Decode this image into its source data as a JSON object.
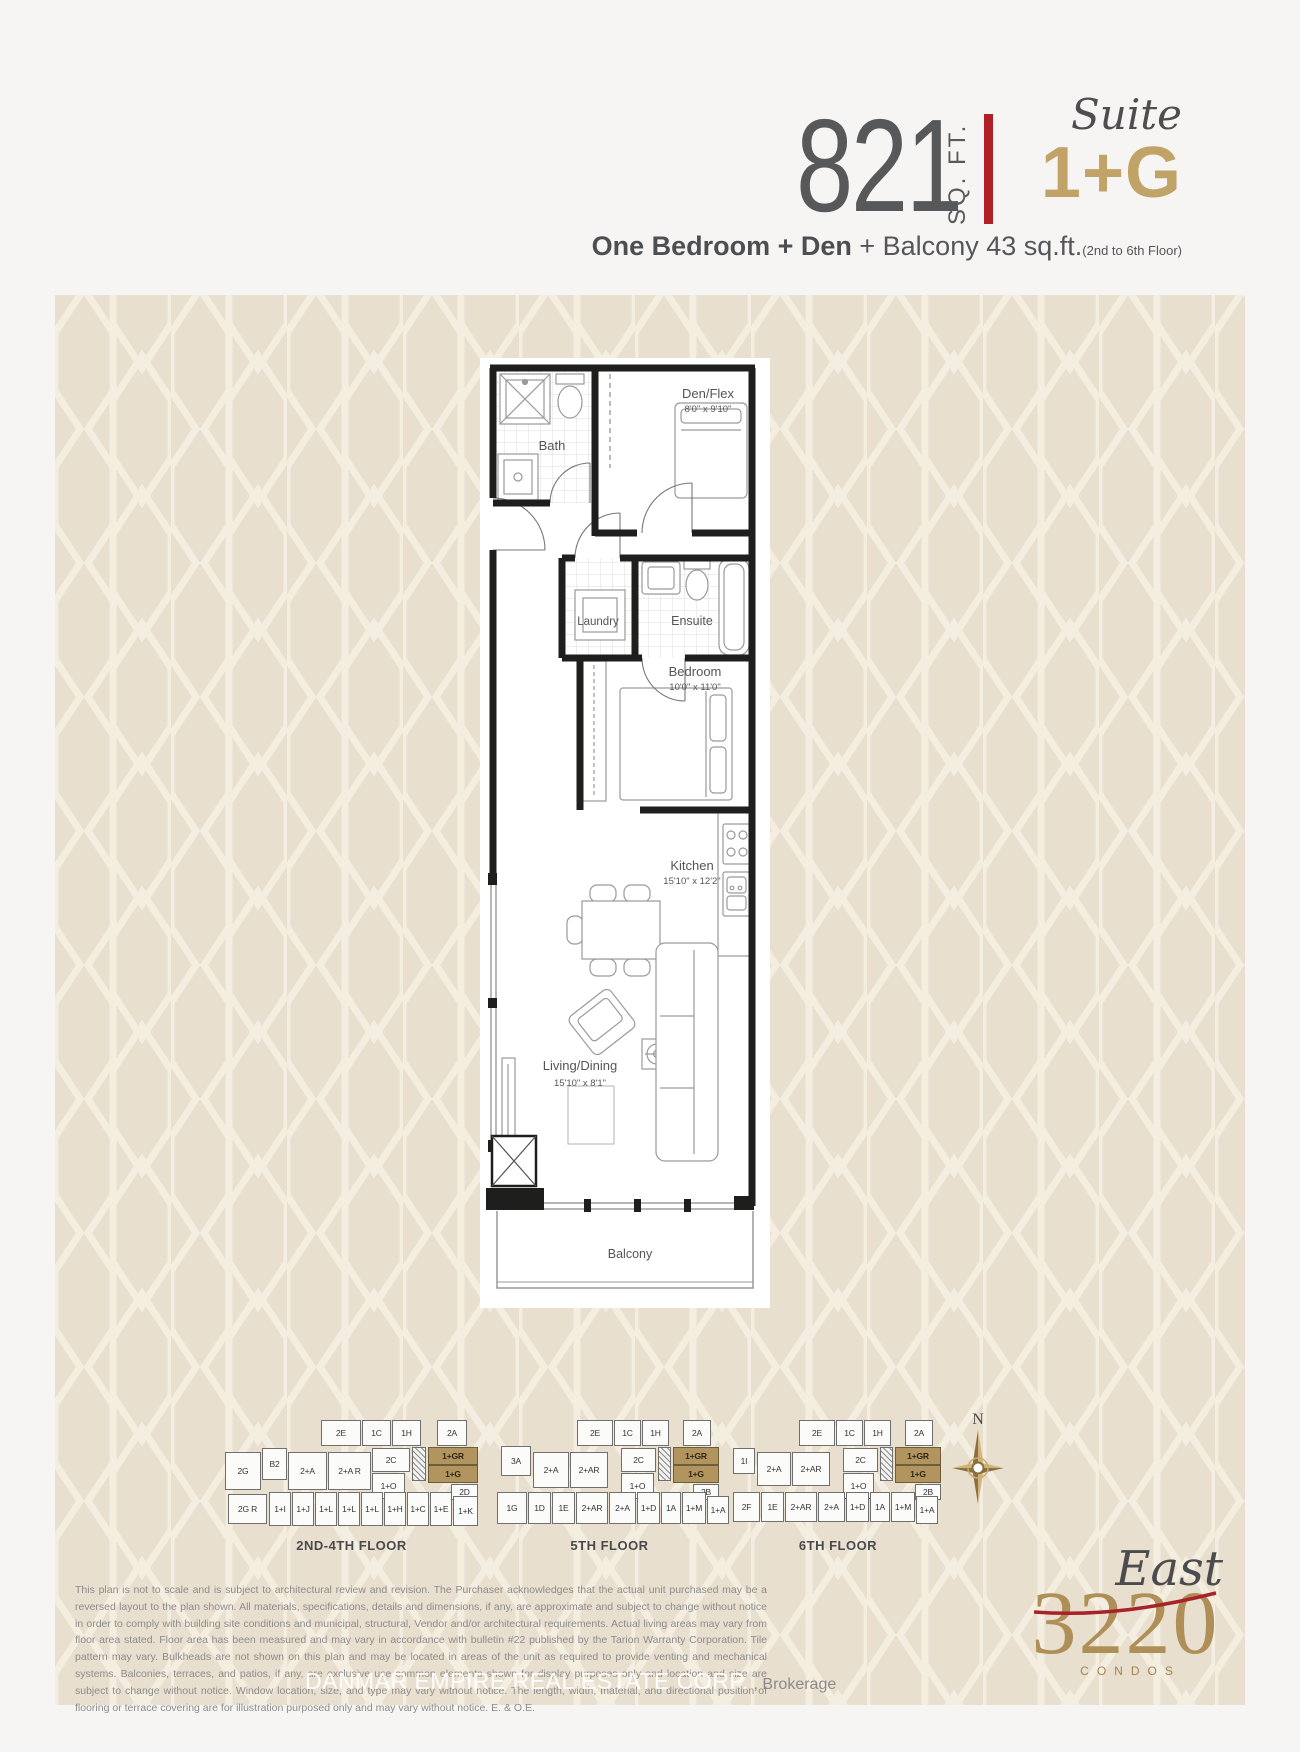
{
  "header": {
    "sqft_value": "821",
    "sqft_unit": "SQ. FT.",
    "suite_word": "Suite",
    "suite_code": "1+G",
    "subtitle": {
      "bold": "One Bedroom + Den",
      "regular": " + Balcony 43 sq.ft.",
      "note": "(2nd to 6th Floor)"
    }
  },
  "floorplan": {
    "bath": {
      "name": "Bath"
    },
    "den": {
      "name": "Den/Flex",
      "dims": "8'0\" x 9'10\""
    },
    "laundry": {
      "name": "Laundry"
    },
    "ensuite": {
      "name": "Ensuite"
    },
    "bedroom": {
      "name": "Bedroom",
      "dims": "10'0\" x 11'0\""
    },
    "kitchen": {
      "name": "Kitchen",
      "dims": "15'10\" x 12'2\""
    },
    "living": {
      "name": "Living/Dining",
      "dims": "15'10\" x 8'1\""
    },
    "balcony": {
      "name": "Balcony"
    }
  },
  "keyplans": [
    {
      "caption": "2ND-4TH FLOOR",
      "units": [
        {
          "t": "2E",
          "x": 96,
          "y": 0,
          "w": 40,
          "h": 26
        },
        {
          "t": "1C",
          "x": 137,
          "y": 0,
          "w": 29,
          "h": 26
        },
        {
          "t": "1H",
          "x": 167,
          "y": 0,
          "w": 29,
          "h": 26
        },
        {
          "t": "2A",
          "x": 212,
          "y": 0,
          "w": 30,
          "h": 26
        },
        {
          "t": "2C",
          "x": 147,
          "y": 28,
          "w": 38,
          "h": 24
        },
        {
          "t": "",
          "x": 187,
          "y": 27,
          "w": 14,
          "h": 34,
          "hatch": 1
        },
        {
          "t": "1+GR",
          "x": 203,
          "y": 27,
          "w": 50,
          "h": 18,
          "gold": 1
        },
        {
          "t": "1+G",
          "x": 203,
          "y": 45,
          "w": 50,
          "h": 18,
          "gold": 1
        },
        {
          "t": "2D",
          "x": 226,
          "y": 64,
          "w": 27,
          "h": 16
        },
        {
          "t": "2G",
          "x": 0,
          "y": 32,
          "w": 36,
          "h": 38
        },
        {
          "t": "B2",
          "x": 37,
          "y": 28,
          "w": 25,
          "h": 32
        },
        {
          "t": "2+A",
          "x": 63,
          "y": 32,
          "w": 39,
          "h": 38
        },
        {
          "t": "2+A R",
          "x": 103,
          "y": 32,
          "w": 43,
          "h": 38
        },
        {
          "t": "1+O",
          "x": 147,
          "y": 53,
          "w": 33,
          "h": 26
        },
        {
          "t": "2G R",
          "x": 3,
          "y": 74,
          "w": 39,
          "h": 30
        },
        {
          "t": "1+I",
          "x": 44,
          "y": 72,
          "w": 22,
          "h": 34
        },
        {
          "t": "1+J",
          "x": 67,
          "y": 72,
          "w": 22,
          "h": 34
        },
        {
          "t": "1+L",
          "x": 90,
          "y": 72,
          "w": 22,
          "h": 34
        },
        {
          "t": "1+L",
          "x": 113,
          "y": 72,
          "w": 22,
          "h": 34
        },
        {
          "t": "1+L",
          "x": 136,
          "y": 72,
          "w": 22,
          "h": 34
        },
        {
          "t": "1+H",
          "x": 159,
          "y": 72,
          "w": 22,
          "h": 34
        },
        {
          "t": "1+C",
          "x": 182,
          "y": 72,
          "w": 22,
          "h": 34
        },
        {
          "t": "1+E",
          "x": 205,
          "y": 72,
          "w": 22,
          "h": 34
        },
        {
          "t": "1+K",
          "x": 228,
          "y": 76,
          "w": 25,
          "h": 30
        }
      ]
    },
    {
      "caption": "5TH FLOOR",
      "units": [
        {
          "t": "2E",
          "x": 80,
          "y": 0,
          "w": 36,
          "h": 26
        },
        {
          "t": "1C",
          "x": 117,
          "y": 0,
          "w": 27,
          "h": 26
        },
        {
          "t": "1H",
          "x": 145,
          "y": 0,
          "w": 27,
          "h": 26
        },
        {
          "t": "2A",
          "x": 186,
          "y": 0,
          "w": 28,
          "h": 26
        },
        {
          "t": "2C",
          "x": 124,
          "y": 28,
          "w": 35,
          "h": 24
        },
        {
          "t": "",
          "x": 161,
          "y": 27,
          "w": 13,
          "h": 34,
          "hatch": 1
        },
        {
          "t": "1+GR",
          "x": 176,
          "y": 27,
          "w": 46,
          "h": 18,
          "gold": 1
        },
        {
          "t": "1+G",
          "x": 176,
          "y": 45,
          "w": 46,
          "h": 18,
          "gold": 1
        },
        {
          "t": "2B",
          "x": 196,
          "y": 64,
          "w": 26,
          "h": 16
        },
        {
          "t": "3A",
          "x": 4,
          "y": 26,
          "w": 30,
          "h": 30
        },
        {
          "t": "2+A",
          "x": 36,
          "y": 32,
          "w": 36,
          "h": 36
        },
        {
          "t": "2+AR",
          "x": 73,
          "y": 32,
          "w": 38,
          "h": 36
        },
        {
          "t": "1+O",
          "x": 124,
          "y": 53,
          "w": 33,
          "h": 26
        },
        {
          "t": "1G",
          "x": 0,
          "y": 72,
          "w": 30,
          "h": 32
        },
        {
          "t": "1D",
          "x": 31,
          "y": 72,
          "w": 23,
          "h": 32
        },
        {
          "t": "1E",
          "x": 55,
          "y": 72,
          "w": 23,
          "h": 32
        },
        {
          "t": "2+AR",
          "x": 79,
          "y": 72,
          "w": 32,
          "h": 32
        },
        {
          "t": "2+A",
          "x": 112,
          "y": 72,
          "w": 27,
          "h": 32
        },
        {
          "t": "1+D",
          "x": 140,
          "y": 72,
          "w": 23,
          "h": 32
        },
        {
          "t": "1A",
          "x": 164,
          "y": 72,
          "w": 20,
          "h": 32
        },
        {
          "t": "1+M",
          "x": 185,
          "y": 72,
          "w": 24,
          "h": 32
        },
        {
          "t": "1+A",
          "x": 210,
          "y": 76,
          "w": 22,
          "h": 28
        }
      ]
    },
    {
      "caption": "6TH FLOOR",
      "units": [
        {
          "t": "2E",
          "x": 66,
          "y": 0,
          "w": 36,
          "h": 26
        },
        {
          "t": "1C",
          "x": 103,
          "y": 0,
          "w": 27,
          "h": 26
        },
        {
          "t": "1H",
          "x": 131,
          "y": 0,
          "w": 27,
          "h": 26
        },
        {
          "t": "2A",
          "x": 172,
          "y": 0,
          "w": 28,
          "h": 26
        },
        {
          "t": "2C",
          "x": 110,
          "y": 28,
          "w": 35,
          "h": 24
        },
        {
          "t": "",
          "x": 147,
          "y": 27,
          "w": 13,
          "h": 34,
          "hatch": 1
        },
        {
          "t": "1+GR",
          "x": 162,
          "y": 27,
          "w": 46,
          "h": 18,
          "gold": 1
        },
        {
          "t": "1+G",
          "x": 162,
          "y": 45,
          "w": 46,
          "h": 18,
          "gold": 1
        },
        {
          "t": "2B",
          "x": 182,
          "y": 64,
          "w": 26,
          "h": 16
        },
        {
          "t": "1I",
          "x": 0,
          "y": 28,
          "w": 22,
          "h": 26
        },
        {
          "t": "2+A",
          "x": 24,
          "y": 32,
          "w": 34,
          "h": 34
        },
        {
          "t": "2+AR",
          "x": 59,
          "y": 32,
          "w": 38,
          "h": 34
        },
        {
          "t": "1+O",
          "x": 110,
          "y": 53,
          "w": 31,
          "h": 26
        },
        {
          "t": "2F",
          "x": 0,
          "y": 72,
          "w": 27,
          "h": 30
        },
        {
          "t": "1E",
          "x": 28,
          "y": 72,
          "w": 23,
          "h": 30
        },
        {
          "t": "2+AR",
          "x": 52,
          "y": 72,
          "w": 32,
          "h": 30
        },
        {
          "t": "2+A",
          "x": 85,
          "y": 72,
          "w": 27,
          "h": 30
        },
        {
          "t": "1+D",
          "x": 113,
          "y": 72,
          "w": 23,
          "h": 30
        },
        {
          "t": "1A",
          "x": 137,
          "y": 72,
          "w": 20,
          "h": 30
        },
        {
          "t": "1+M",
          "x": 158,
          "y": 72,
          "w": 24,
          "h": 30
        },
        {
          "t": "1+A",
          "x": 183,
          "y": 76,
          "w": 22,
          "h": 28
        }
      ]
    }
  ],
  "compass": {
    "label": "N"
  },
  "disclaimer": {
    "text": "This plan is not to scale and is subject to architectural review and revision. The Purchaser acknowledges that the actual unit purchased may be a reversed layout to the plan shown. All materials, specifications, details and dimensions, if any, are approximate and subject to change without notice in order to comply with building site conditions and municipal, structural, Vendor and/or architectural requirements. Actual living areas may vary from floor area stated. Floor area has been measured and may vary in accordance with bulletin #22 published by the Tarion Warranty Corporation. Tile pattern may vary. Bulkheads are not shown on this plan and may be located in areas of the unit as required to provide venting and mechanical systems. Balconies, terraces, and patios, if any, are exclusive use common elements shown for display purposes only and location and size are subject to change without notice. Window location, size, and type may vary without notice. The length, width, material, and directional position of flooring or terrace covering are for illustration purposed only and may vary without notice. E. & O.E."
  },
  "watermark": {
    "main": "DANMAR EMPIRE REAL ESTATE CORP.",
    "suffix": ", Brokerage"
  },
  "logo": {
    "script": "East",
    "number": "3220",
    "word": "CONDOS"
  },
  "colors": {
    "accent_red": "#b02025",
    "suite_gold": "#c2a367",
    "keyplan_gold": "#b2945f",
    "logo_gold": "#ae8f58",
    "pattern_base": "#e9dfcf",
    "pattern_line": "#f4eee1"
  }
}
